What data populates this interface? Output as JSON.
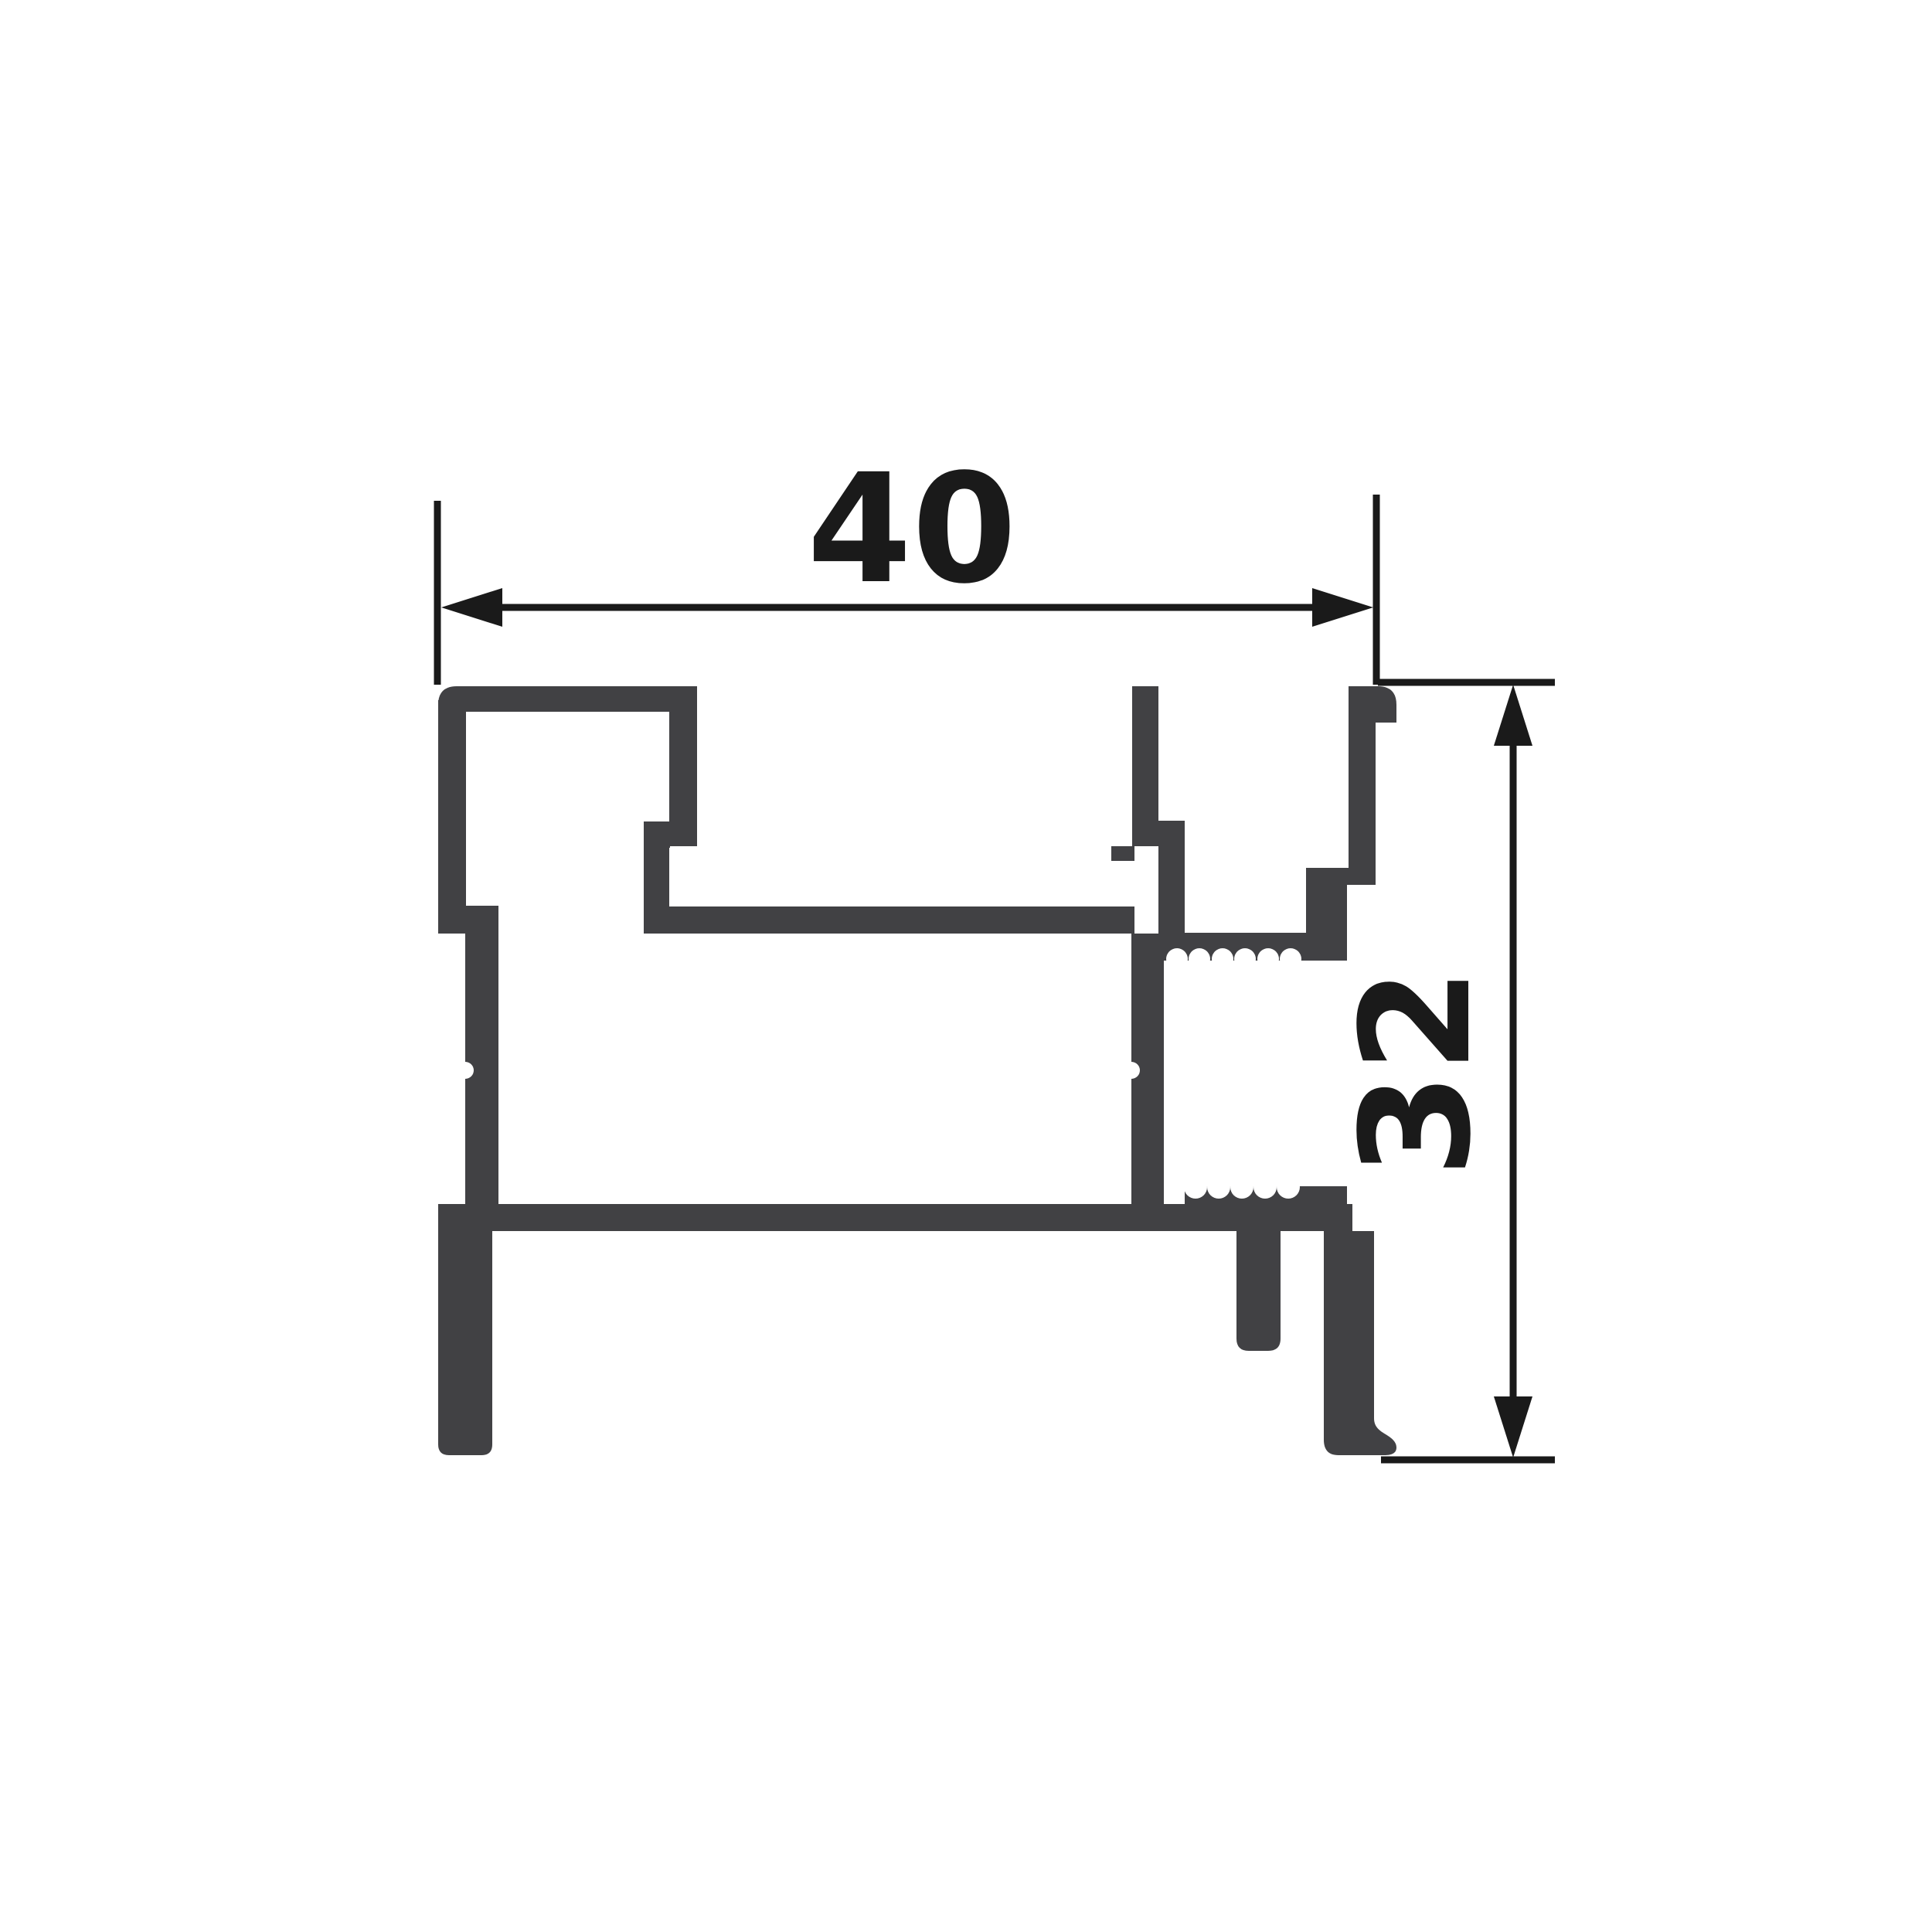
{
  "drawing": {
    "title": "Aluminium profile cross-section",
    "type": "technical-drawing"
  },
  "theme": {
    "background": "#ffffff",
    "profile_fill": "#414144",
    "dimension_color": "#1a1a1a"
  },
  "dimensions": {
    "width": {
      "label": "40",
      "orientation": "horizontal"
    },
    "height": {
      "label": "32",
      "orientation": "vertical"
    }
  }
}
